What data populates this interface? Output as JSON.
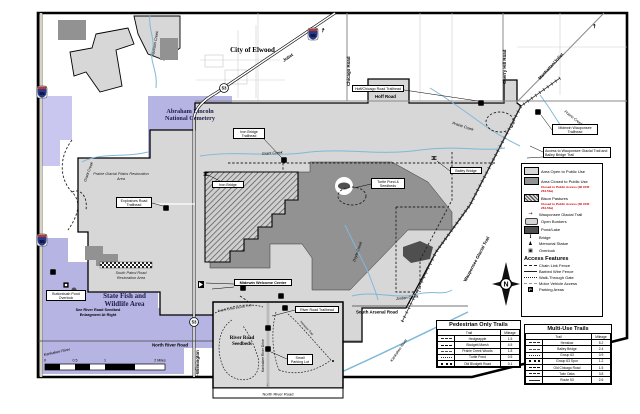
{
  "colors": {
    "area_open": "#d7d7d7",
    "area_closed": "#929292",
    "pond_lake": "#4f4f4f",
    "public_lands_purple": "#b6b4e3",
    "creek_blue": "#7fb8d8",
    "closed_note_red": "#cc0000"
  },
  "map": {
    "north_label": "N",
    "symbols": {
      "parking": "P",
      "arrow_ne": "↗",
      "arrow_down": "↓"
    },
    "area_labels": {
      "city_of_elwood": "City of Elwood",
      "cemetery_line1": "Abraham Lincoln",
      "cemetery_line2": "National Cemetery",
      "state_fish_line1": "State Fish and",
      "state_fish_line2": "Wildlife Area",
      "prairie_glacial": "Prairie Glacial Plains Restoration Area",
      "south_patrol": "South Patrol Road Restoration Area",
      "see_river_note": "See River Road Seedbed Enlargment At Right",
      "river_road_seedbeds_line1": "River Road",
      "river_road_seedbeds_line2": "Seedbeds"
    },
    "roads": {
      "hoff": "Hoff Road",
      "chicago": "Chicago Road",
      "cherry_hill": "Cherry Hill Road",
      "north_river": "North River Road",
      "north_river_inset": "North River Road",
      "south_arsenal": "South Arsenal Road",
      "kankakee_drive": "Kankakee River Drive",
      "joliet": "Joliet",
      "manhattan_joliet": "Manhattan/Joliet",
      "wilmington": "Wilmington",
      "route53": "53",
      "i55": "55"
    },
    "water": {
      "jackson": "Jackson Creek",
      "grant": "Grant Creek",
      "prairie": "Prairie Creek",
      "doyle": "Doyle Creek",
      "jordan": "Jordan Creek",
      "kankakee": "Kankakee River"
    },
    "trails": {
      "wauponsee": "Wauponsee Glacial Trail",
      "prairie_creek_woods": "Prairie Creek Woods Trail",
      "henslow": "Henslow Trail"
    },
    "callouts": {
      "hoff_chicago_trailhead": "Hoff/Chicago Road Trailhead",
      "midewin_wauponsee_trailhead": "Midewin Wauponsee Trailhead",
      "access_note": "Access to Wauponsee Glacial Trail and Bailey Bridge Trail",
      "iron_bridge_trailhead": "Iron Bridge Trailhead",
      "iron_bridge": "Iron Bridge",
      "bailey_bridge": "Bailey Bridge",
      "turtle_pond_seedbeds": "Turtle Pond & Seedbeds",
      "explosives_road_trailhead": "Explosives Road Trailhead",
      "buttonbush_pond_overlook": "Buttonbush Pond Overlook",
      "midewin_welcome_center": "Midewin Welcome Center",
      "river_road_trailhead": "River Road Trailhead",
      "small_parking_lot": "Small Parking Lot"
    },
    "scale": {
      "zero": "0",
      "half": "0.5",
      "one": "1",
      "two_miles": "2 Miles"
    }
  },
  "legend": {
    "items": [
      {
        "label": "Area Open to Public Use"
      },
      {
        "label": "Area Closed to Public Use",
        "note": "Closed to Public Access (36 CFR 261.53e)"
      },
      {
        "label": "Bison Pastures",
        "note": "Closed to Public Access (36 CFR 261.53e)"
      },
      {
        "label": "Wauponsee Glacial Trail"
      },
      {
        "label": "Open Bunkers"
      },
      {
        "label": "Pond/Lake"
      },
      {
        "label": "Bridge"
      },
      {
        "label": "Memorial Statue"
      },
      {
        "label": "Overlook"
      }
    ],
    "access_title": "Access Features",
    "access_items": [
      {
        "label": "Chain Link Fence"
      },
      {
        "label": "Barbed Wire Fence"
      },
      {
        "label": "Walk-Through Gate"
      },
      {
        "label": "Motor Vehicle Access"
      },
      {
        "label": "Parking Areas"
      }
    ]
  },
  "tables": {
    "pedestrian": {
      "title": "Pedestrian Only Trails",
      "col_trail": "Trail",
      "col_mileage": "Mileage",
      "rows": [
        {
          "trail": "Hedgeapple",
          "mileage": "1.5"
        },
        {
          "trail": "Blodgett Marsh",
          "mileage": "4.5"
        },
        {
          "trail": "Prairie Creek Woods",
          "mileage": "1.8"
        },
        {
          "trail": "Turtle Pond",
          "mileage": "0.5"
        },
        {
          "trail": "Old Blodgett Road",
          "mileage": "0.1"
        }
      ]
    },
    "multiuse": {
      "title": "Multi-Use Trails",
      "col_trail": "Trail",
      "col_mileage": "Mileage",
      "rows": [
        {
          "trail": "Henslow",
          "mileage": "5.2"
        },
        {
          "trail": "Bailey Bridge",
          "mileage": "2.4"
        },
        {
          "trail": "Group 63",
          "mileage": "0.9"
        },
        {
          "trail": "Group 63 Spur",
          "mileage": "1.2"
        },
        {
          "trail": "Old Chicago Road",
          "mileage": "1.5"
        },
        {
          "trail": "Twin Oaks",
          "mileage": "3.8"
        },
        {
          "trail": "Route 53",
          "mileage": "2.6"
        }
      ]
    }
  }
}
